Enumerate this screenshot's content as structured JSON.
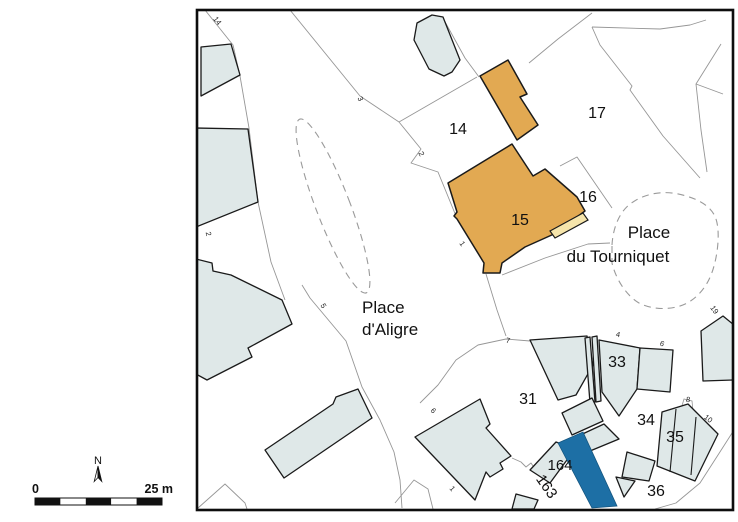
{
  "map": {
    "place_labels": [
      {
        "text": "Place"
      },
      {
        "text": "d'Aligre"
      },
      {
        "text": "Place"
      },
      {
        "text": "du Tourniquet"
      }
    ],
    "parcel_numbers": [
      "14",
      "17",
      "15",
      "16",
      "31",
      "33",
      "34",
      "35",
      "36",
      "164",
      "163"
    ],
    "street_numbers": [
      "14",
      "3",
      "2",
      "2",
      "5",
      "1",
      "7",
      "6",
      "1",
      "4",
      "6",
      "19",
      "8",
      "10"
    ],
    "colors": {
      "building_fill": "#dfe8e8",
      "building_outline": "#1a1a1a",
      "highlighted_building_fill": "#e2a952",
      "highlighted_light_strip_fill": "#f6e5ab",
      "selected_building_fill": "#1d6fa5",
      "street_line": "#969696",
      "dashed_outline": "#9a9a9a"
    }
  },
  "legend": {
    "scale_start": "0",
    "scale_end": "25 m",
    "north_label": "N"
  }
}
